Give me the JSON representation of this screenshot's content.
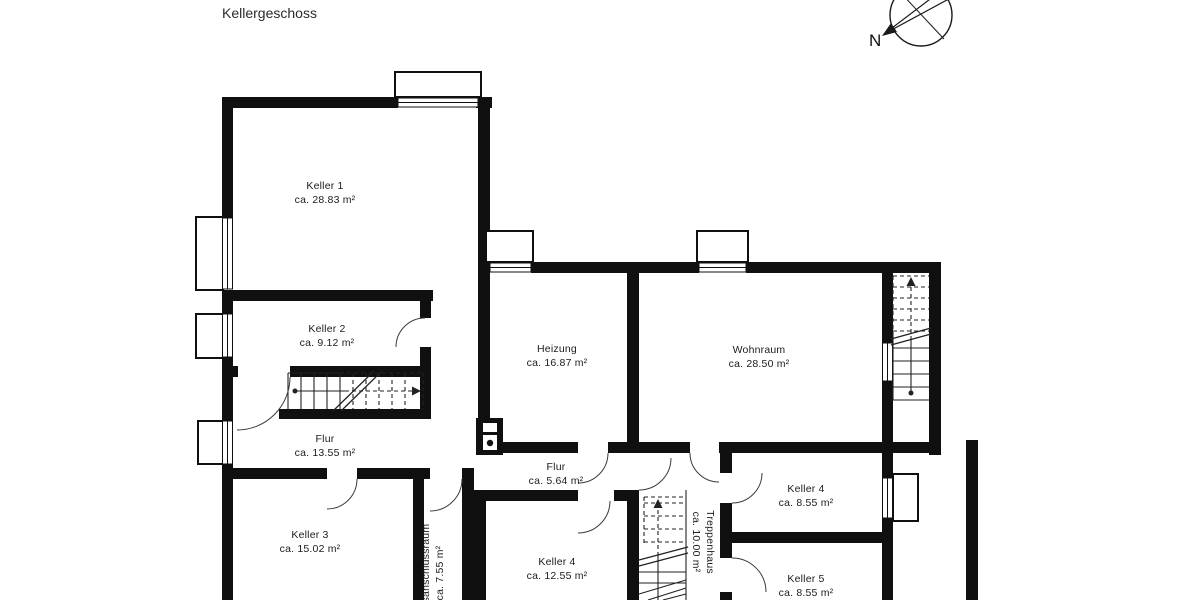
{
  "title": "Kellergeschoss",
  "compass": {
    "north_label": "N"
  },
  "colors": {
    "wall": "#101010",
    "thin_line": "#222222",
    "door_arc": "#3a3a3a",
    "text": "#1c1c1c"
  },
  "rooms": [
    {
      "name": "Keller 1",
      "area": "ca. 28.83 m²"
    },
    {
      "name": "Keller 2",
      "area": "ca. 9.12 m²"
    },
    {
      "name": "Heizung",
      "area": "ca. 16.87 m²"
    },
    {
      "name": "Wohnraum",
      "area": "ca. 28.50 m²"
    },
    {
      "name": "Flur",
      "area": "ca. 13.55 m²"
    },
    {
      "name": "Flur",
      "area": "ca. 5.64 m²"
    },
    {
      "name": "Keller 3",
      "area": "ca. 15.02 m²"
    },
    {
      "name": "Keller 4",
      "area": "ca. 12.55 m²"
    },
    {
      "name": "Keller 4",
      "area": "ca. 8.55 m²"
    },
    {
      "name": "Keller 5",
      "area": "ca. 8.55 m²"
    },
    {
      "name": "Treppenhaus",
      "area": "ca. 10.00 m²"
    },
    {
      "name": "Hausanschlussraum",
      "area": "ca. 7.55 m²"
    }
  ]
}
